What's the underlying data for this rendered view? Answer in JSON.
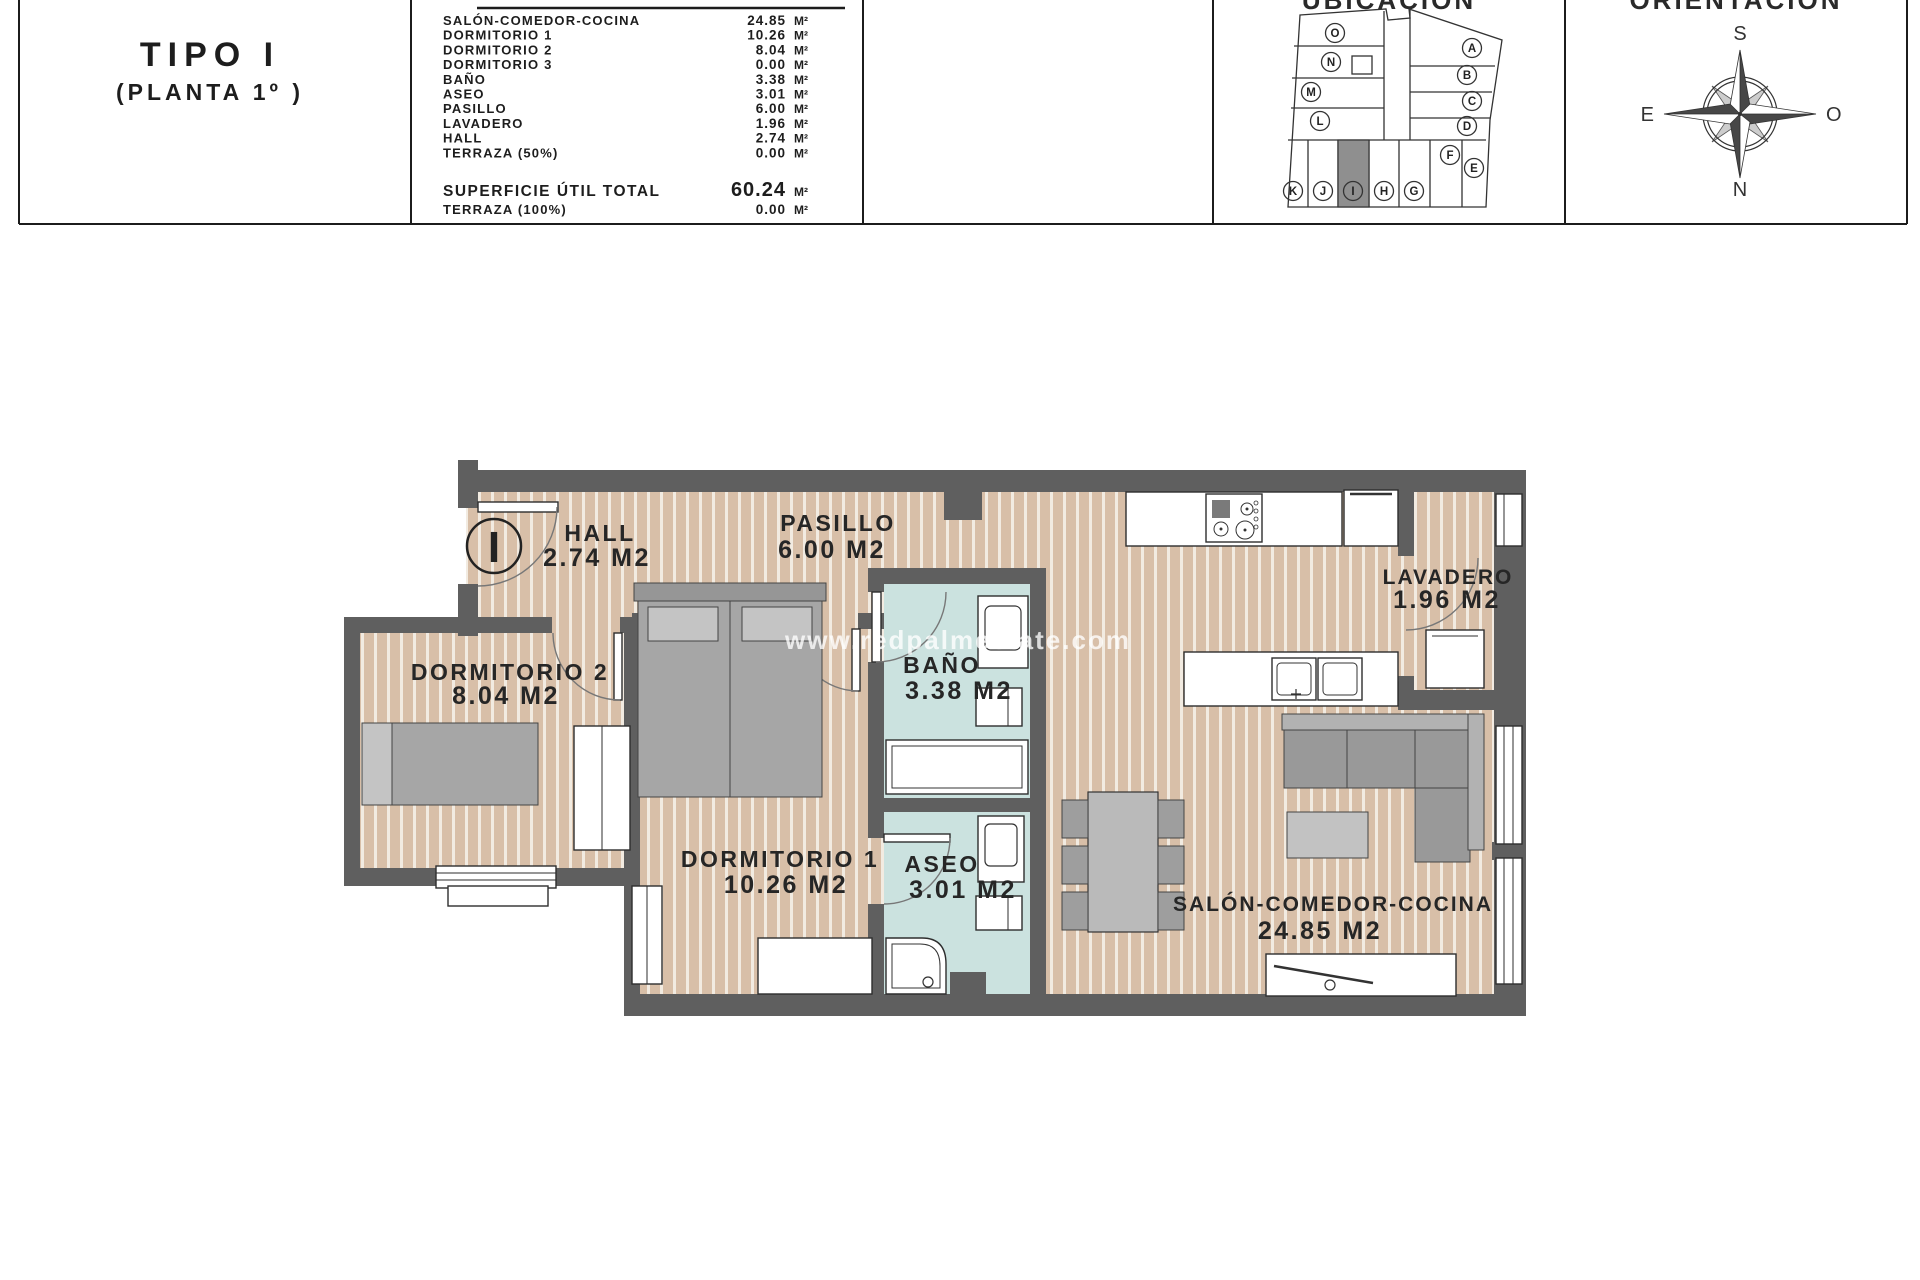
{
  "header": {
    "type_title": "TIPO I",
    "type_subtitle": "(PLANTA 1º )",
    "table": {
      "unit": "M²",
      "rows": [
        {
          "label": "SALÓN-COMEDOR-COCINA",
          "value": "24.85"
        },
        {
          "label": "DORMITORIO 1",
          "value": "10.26"
        },
        {
          "label": "DORMITORIO 2",
          "value": "8.04"
        },
        {
          "label": "DORMITORIO 3",
          "value": "0.00"
        },
        {
          "label": "BAÑO",
          "value": "3.38"
        },
        {
          "label": "ASEO",
          "value": "3.01"
        },
        {
          "label": "PASILLO",
          "value": "6.00"
        },
        {
          "label": "LAVADERO",
          "value": "1.96"
        },
        {
          "label": "HALL",
          "value": "2.74"
        },
        {
          "label": "TERRAZA (50%)",
          "value": "0.00"
        }
      ],
      "total_label": "SUPERFICIE ÚTIL TOTAL",
      "total_value": "60.24",
      "extra_label": "TERRAZA (100%)",
      "extra_value": "0.00"
    },
    "ubicacion_title": "UBICACIÓN",
    "orientacion_title": "ORIENTACIÓN"
  },
  "site_plan": {
    "units": [
      "A",
      "B",
      "C",
      "D",
      "E",
      "F",
      "G",
      "H",
      "I",
      "J",
      "K",
      "L",
      "M",
      "N",
      "O"
    ],
    "highlighted_unit": "I"
  },
  "compass": {
    "top": "S",
    "right": "O",
    "bottom": "N",
    "left": "E"
  },
  "floor_plan": {
    "unit_marker": "I",
    "watermark": "www.redpalmestate.com",
    "rooms": [
      {
        "name": "HALL",
        "area": "2.74 M2"
      },
      {
        "name": "PASILLO",
        "area": "6.00 M2"
      },
      {
        "name": "LAVADERO",
        "area": "1.96 M2"
      },
      {
        "name": "DORMITORIO 2",
        "area": "8.04 M2"
      },
      {
        "name": "BAÑO",
        "area": "3.38 M2"
      },
      {
        "name": "DORMITORIO 1",
        "area": "10.26 M2"
      },
      {
        "name": "ASEO",
        "area": "3.01 M2"
      },
      {
        "name": "SALÓN-COMEDOR-COCINA",
        "area": "24.85 M2"
      }
    ]
  },
  "colors": {
    "wall": "#5f5f5f",
    "floor": "#d8bfa8",
    "floor_stripe": "#f2ebe1",
    "wet_floor": "#cbe2df",
    "furniture": "#a6a6a6",
    "label": "#262626"
  }
}
